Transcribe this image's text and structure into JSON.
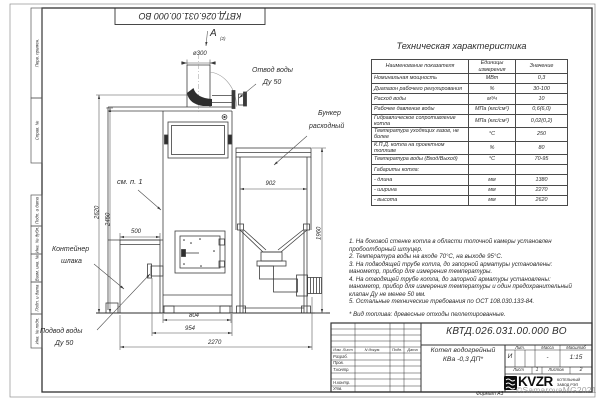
{
  "sheet": {
    "top_stamp": "КВТД.026.031.00.000 ВО",
    "format_note": "Формат А3",
    "watermark": "©SamarovaMG2021",
    "margin_stamps": [
      "Перв. примен.",
      "Справ. №",
      "Подп. и дата",
      "Инв. № дубл.",
      "Взам. инв. №",
      "Подп. и дата",
      "Инв. № подл."
    ]
  },
  "spec_table": {
    "title": "Техническая характеристика",
    "headers": [
      "Наименование показателя",
      "Единицы\nизмерения",
      "Значение"
    ],
    "rows": [
      [
        "Номинальная мощность",
        "МВт",
        "0,3"
      ],
      [
        "Диапазон рабочего регулирования",
        "%",
        "30-100"
      ],
      [
        "Расход воды",
        "м³/ч",
        "10"
      ],
      [
        "Рабочее давление воды",
        "МПа (кгс/см²)",
        "0,6(6,0)"
      ],
      [
        "Гидравлическое сопротивление котла",
        "МПа (кгс/см²)",
        "0,02(0,2)"
      ],
      [
        "Температура уходящих газов, не более",
        "°С",
        "250"
      ],
      [
        "К.П.Д. котла на проектном топливе",
        "%",
        "80"
      ],
      [
        "Температура воды (Вход/Выход)",
        "°С",
        "70-95"
      ],
      [
        "Габариты котла:",
        "",
        ""
      ],
      [
        "- длина",
        "мм",
        "1380"
      ],
      [
        "- ширина",
        "мм",
        "2270"
      ],
      [
        "- высота",
        "мм",
        "2620"
      ]
    ]
  },
  "notes": {
    "lines": [
      "1. На боковой стенке котла в области топочной камеры установлен",
      "пробоотборный штуцер.",
      "2. Температура воды на входе 70°С, на выходе 95°С.",
      "3. На подводящей трубе котла, до запорной арматуры установлены:",
      "манометр, прибор для измерения температуры.",
      "4. На отводящей трубе котла, до запорной арматуры установлены:",
      "манометр, прибор для измерения температуры и один предохранительный",
      "клапан Ду не менее 50 мм.",
      "5. Остальные технические требования по ОСТ 108.030.133-84.",
      "",
      "* Вид топлива: древесные отходы пеллетированные."
    ]
  },
  "drawing": {
    "view_label": "A",
    "view_ref": "(2)",
    "dims": {
      "flue": "ø300",
      "h_total": "2620",
      "h_boiler": "2450",
      "w_container": "500",
      "w_furnace": "804",
      "w_inlet": "954",
      "w_total": "2270",
      "w_bunker": "902",
      "h_bunker": "1960"
    },
    "callouts": {
      "outlet_1": "Отвод воды",
      "outlet_2": "Ду 50",
      "bunker_1": "Бункер",
      "bunker_2": "расходный",
      "see_note": "см. п. 1",
      "container_1": "Контейнер",
      "container_2": "шлака",
      "inlet_1": "Подвод воды",
      "inlet_2": "Ду 50"
    }
  },
  "title_block": {
    "number": "КВТД.026.031.00.000  ВО",
    "product_1": "Котел водогрейный",
    "product_2": "КВа -0,3  ДП*",
    "col_headers": [
      "Изм. Лист",
      "N докум.",
      "Подп.",
      "Дата"
    ],
    "roles": [
      "Разраб.",
      "Пров.",
      "Т.контр.",
      "Н.контр.",
      "Утв."
    ],
    "lit_h": "Лит.",
    "mass_h": "Масса",
    "scale_h": "Масштаб",
    "lit": "И",
    "mass": "-",
    "scale": "1:15",
    "sheet_h": "Лист",
    "sheet": "1",
    "sheets_h": "Листов",
    "sheets": "2",
    "logo": "KVZR",
    "logo_sub_1": "КОТЕЛЬНЫЙ",
    "logo_sub_2": "ЗАВОД РЭП"
  }
}
